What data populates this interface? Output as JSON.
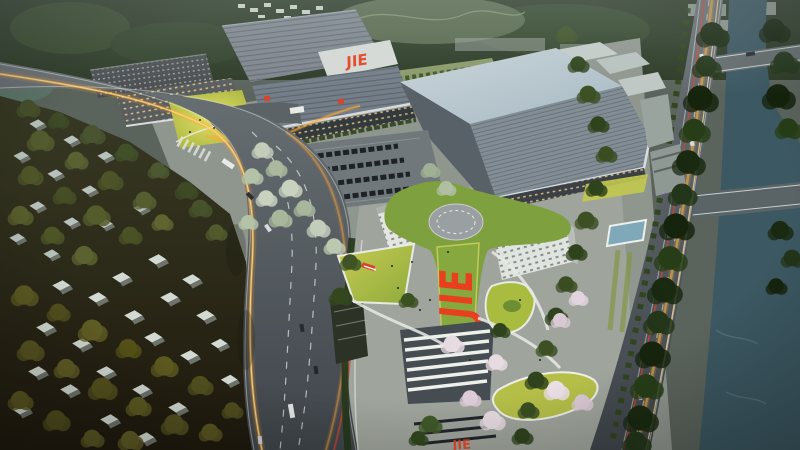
{
  "scene": {
    "description": "Dusk aerial rendering of the JIE industrial campus: large factory halls, a Y-shaped headquarters with rooftop helipad and giant JIE roof logo, bright landscaped lawns, a parking lot, a curving avenue with glowing traffic light-trails, a riverside road, a tree-lined canal with two bridges, and a low-rise village in shadow.",
    "time_of_day": "dusk",
    "view": "aerial-oblique"
  },
  "branding": {
    "company": "JIE",
    "factory_wall_logo": "JIE",
    "headquarters_roof_logo": "JIE",
    "entrance_plaza_logo": "JIE"
  },
  "palette": {
    "jie_red": "#e8401f",
    "hq_roof_green": "#7fa03e",
    "hq_roof_strip": "#87a83f",
    "helipad_gray": "#9aa0a2",
    "lawn_bright": "#c9cc52",
    "lawn_teardrop": "#a9bc40",
    "river_teal": "#3c5862",
    "bank_trees_dark": "#182a12",
    "factory_roof_gray": "#7e858d",
    "warehouse_roof_blue": "#a8bac3",
    "road_asphalt": "#565e63",
    "light_trail_orange": "#ffb13e",
    "light_trail_red": "#d8432c",
    "residential_ground": "#241c11",
    "house_wall": "#d2dad3",
    "tree_olive": "#5c5a22",
    "blossom_tree": "#e7dbe2",
    "path_white": "#e8eae4",
    "hills_dark": "#2c3a26"
  }
}
